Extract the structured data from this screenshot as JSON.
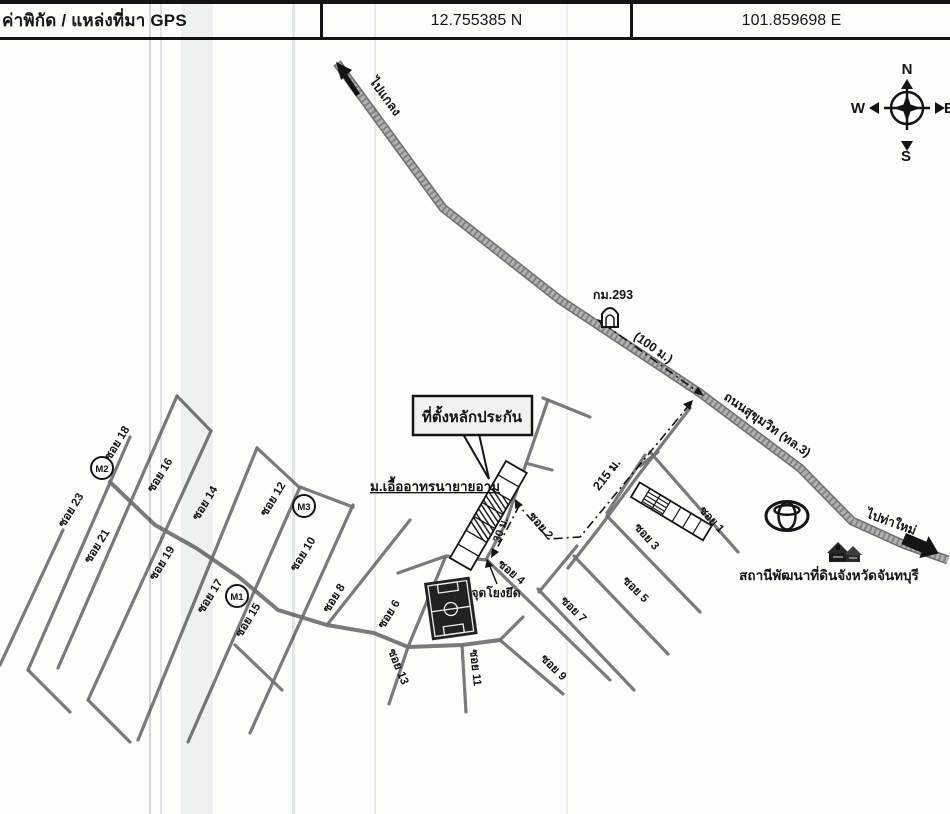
{
  "header": {
    "label": "ค่าพิกัด / แหล่งที่มา GPS",
    "latitude": "12.755385 N",
    "longitude": "101.859698 E"
  },
  "compass": {
    "n": "N",
    "w": "W",
    "e": "E",
    "s": "S"
  },
  "map": {
    "dir_northwest": "ไปแกลง",
    "dir_southeast": "ไปท่าใหม่",
    "highway_name": "ถนนสุขุมวิท (ทล.3)",
    "km_marker": "กม.293",
    "dist_100m": "(100 ม.)",
    "dist_215m": "215 ม.",
    "dist_30m": "30 ม.",
    "callout_collateral": "ที่ตั้งหลักประกัน",
    "estate_name": "ม.เอื้ออาทรนายายอาม",
    "anchor_point": "จุดโยงยึด",
    "land_station": "สถานีพัฒนาที่ดินจังหวัดจันทบุรี",
    "markers": [
      {
        "label": "M2"
      },
      {
        "label": "M3"
      },
      {
        "label": "M1"
      }
    ],
    "sois": [
      {
        "label": "ซอย 18"
      },
      {
        "label": "ซอย 16"
      },
      {
        "label": "ซอย 23"
      },
      {
        "label": "ซอย 14"
      },
      {
        "label": "ซอย 12"
      },
      {
        "label": "ซอย 21"
      },
      {
        "label": "ซอย 19"
      },
      {
        "label": "ซอย 10"
      },
      {
        "label": "ซอย 17"
      },
      {
        "label": "ซอย 15"
      },
      {
        "label": "ซอย 8"
      },
      {
        "label": "ซอย 6"
      },
      {
        "label": "ซอย 13"
      },
      {
        "label": "ซอย 11"
      },
      {
        "label": "ซอย 9"
      },
      {
        "label": "ซอย 7"
      },
      {
        "label": "ซอย 5"
      },
      {
        "label": "ซอย 4"
      },
      {
        "label": "ซอย 3"
      },
      {
        "label": "ซอย 2"
      },
      {
        "label": "ซอย 1"
      }
    ],
    "icons": {
      "compass": "compass-rose",
      "toyota": "toyota-logo",
      "milestone": "km-milestone",
      "soccer": "soccer-field",
      "station": "land-station-buildings"
    }
  },
  "colors": {
    "paper": "#fdfdfc",
    "ink": "#141414",
    "road_gray": "#6f6f6f",
    "highway_gray": "#9a9a9a"
  }
}
